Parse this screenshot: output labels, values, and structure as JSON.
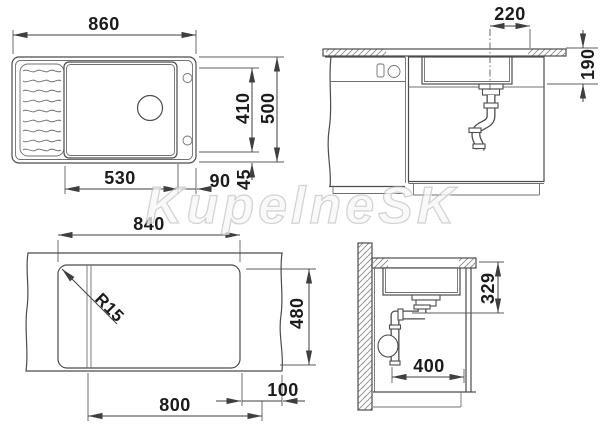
{
  "watermark": {
    "text": "KupelneSK"
  },
  "plan_view": {
    "overall_width": "860",
    "bowl_width": "530",
    "bowl_to_edge": "90",
    "edge_strip": "45",
    "bowl_depth": "410",
    "overall_depth": "500"
  },
  "front_section": {
    "drain_to_edge": "220",
    "rim_to_bowl_bottom": "190"
  },
  "cutout_view": {
    "cutout_width": "840",
    "cutout_depth": "480",
    "lower_span": "800",
    "edge_gap": "100",
    "corner_radius": "R15"
  },
  "side_section": {
    "top_to_drain_outlet": "329",
    "trap_to_front": "400"
  }
}
